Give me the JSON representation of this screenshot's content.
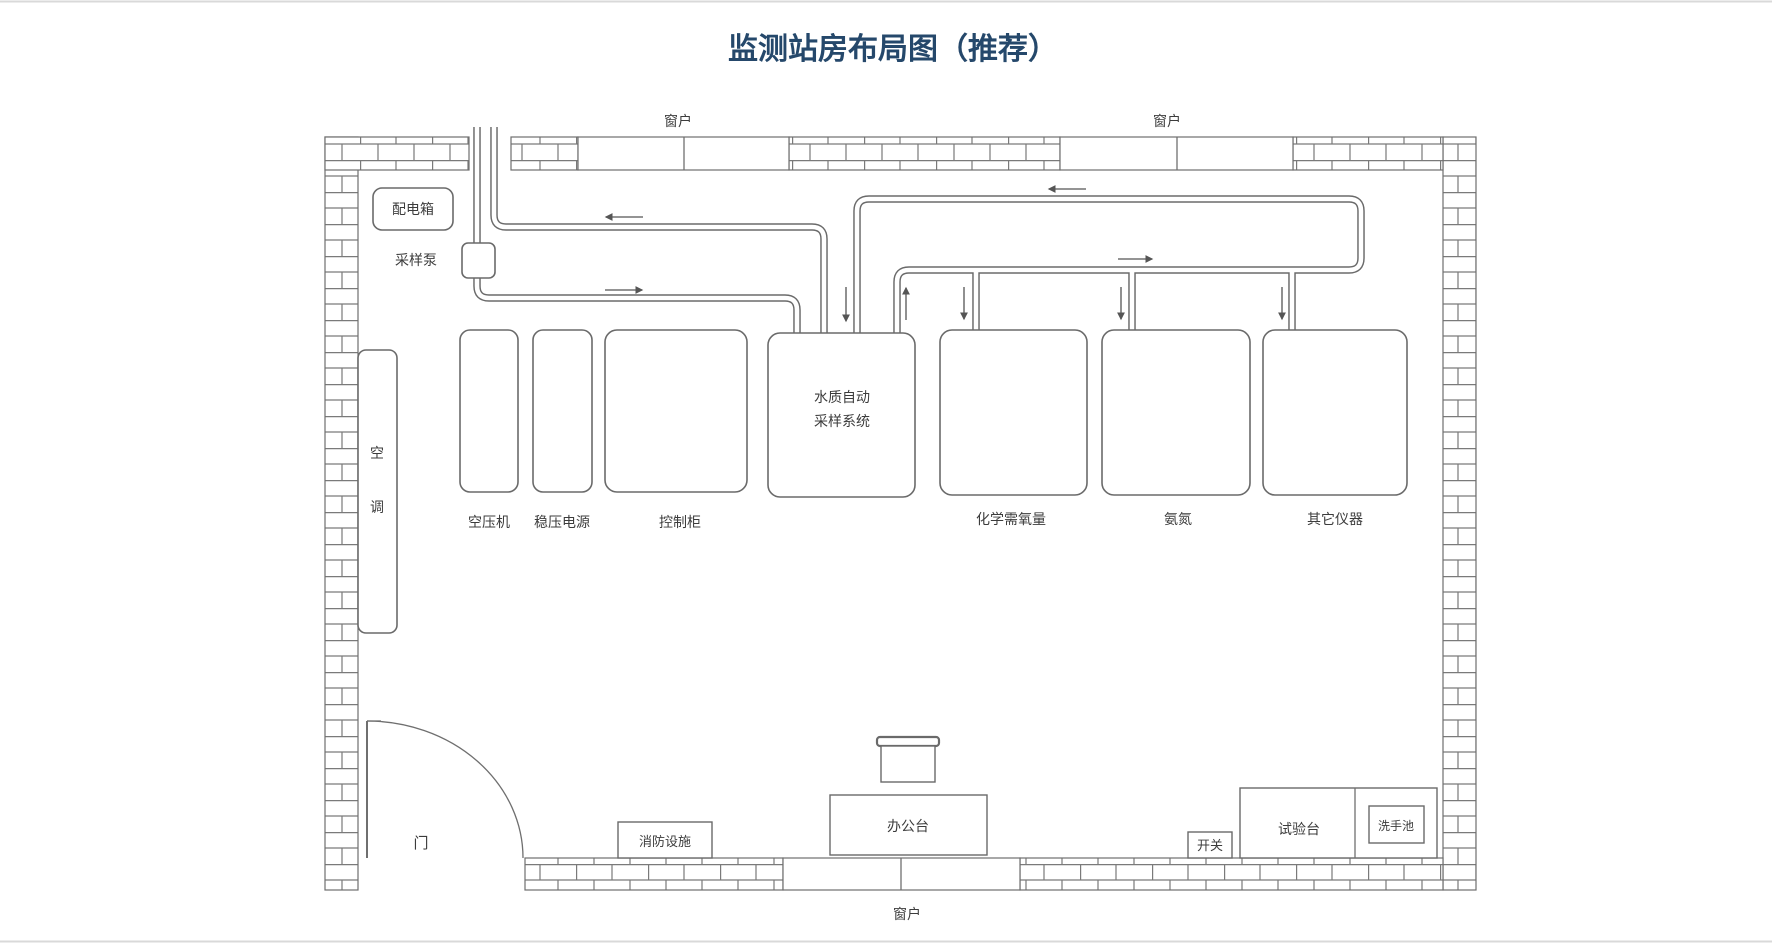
{
  "title": "监测站房布局图（推荐）",
  "room": {
    "window_top_left": "窗户",
    "window_top_right": "窗户",
    "window_bottom": "窗户",
    "door": "门"
  },
  "equipment": {
    "distribution_box": "配电箱",
    "sampling_pump": "采样泵",
    "air_conditioner": {
      "char1": "空",
      "char2": "调"
    },
    "air_compressor": "空压机",
    "stabilized_power": "稳压电源",
    "control_cabinet": "控制柜",
    "water_sampler": {
      "line1": "水质自动",
      "line2": "采样系统"
    },
    "cod_analyzer": "化学需氧量",
    "ammonia_analyzer": "氨氮",
    "other_instruments": "其它仪器"
  },
  "furniture": {
    "fire_equipment": "消防设施",
    "office_desk": "办公台",
    "switch": "开关",
    "test_bench": "试验台",
    "sink": "洗手池"
  },
  "colors": {
    "title_text": "#25486B",
    "wall_line": "#7a7a7a",
    "pipe_line": "#6a6a6a",
    "label_text": "#3c3c3c"
  }
}
